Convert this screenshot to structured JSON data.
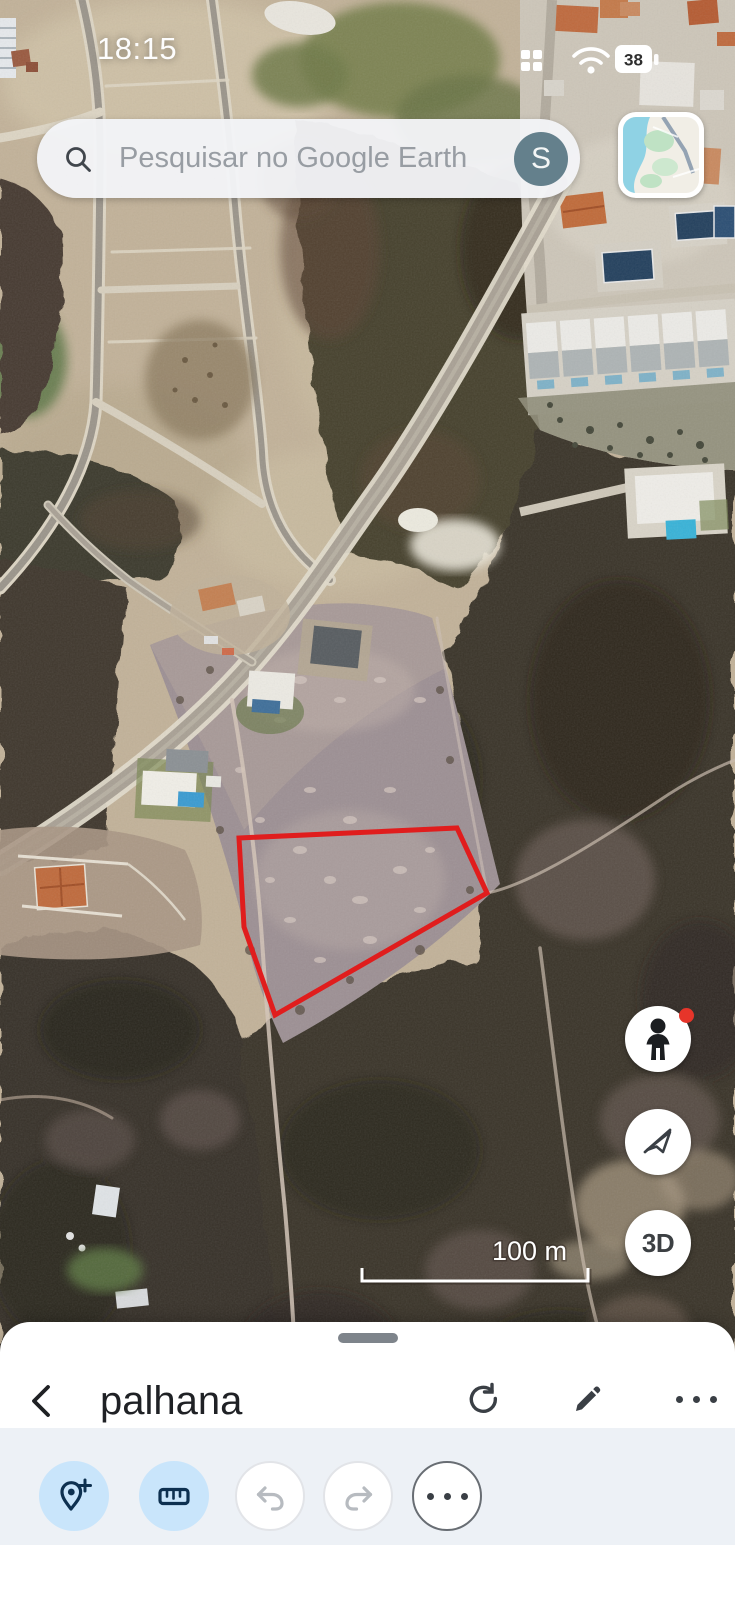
{
  "status_bar": {
    "time": "18:15",
    "battery_level": "38"
  },
  "search_bar": {
    "placeholder": "Pesquisar no Google Earth",
    "account_initial": "S"
  },
  "map": {
    "type": "satellite-imagery",
    "scale_label": "100 m",
    "annotation": {
      "shape": "polygon",
      "stroke_color": "#e01d1d",
      "vertices_px": [
        [
          239,
          838
        ],
        [
          457,
          828
        ],
        [
          487,
          893
        ],
        [
          275,
          1015
        ],
        [
          244,
          927
        ]
      ]
    }
  },
  "map_controls": {
    "threed_label": "3D",
    "buttons": [
      "street-view-pegman",
      "fly-mode-disabled",
      "3d-toggle"
    ],
    "pegman_notification_dot": true
  },
  "minimap": {
    "style": "roadmap-preview"
  },
  "bottom_sheet": {
    "title": "palhana",
    "header_actions": [
      "back",
      "refresh",
      "edit",
      "more"
    ],
    "toolbar_buttons": [
      "add-placemark",
      "measure",
      "undo",
      "redo",
      "more"
    ],
    "toolbar_states": {
      "add-placemark": "active",
      "measure": "active",
      "undo": "disabled",
      "redo": "disabled",
      "more": "enabled"
    }
  },
  "icons": {
    "search-icon": "magnifier",
    "grid-icon": "2x2-dots",
    "wifi-icon": "wifi-arcs",
    "battery-icon": "battery-with-percent",
    "pegman-icon": "person-silhouette",
    "fly-disabled-icon": "paper-plane-slash",
    "back-icon": "chevron-left",
    "refresh-icon": "circular-arrow",
    "edit-icon": "pencil",
    "more-icon": "three-dots",
    "add-placemark-icon": "pin-plus",
    "measure-icon": "ruler",
    "undo-icon": "arrow-curve-left",
    "redo-icon": "arrow-curve-right"
  },
  "colors": {
    "accent_button_bg": "#c9e5fb",
    "tool_icon_navy": "#0d3050",
    "polygon_red": "#e01d1d",
    "avatar_bg": "#64808c",
    "toolbar_section_bg": "#edf1f6"
  }
}
